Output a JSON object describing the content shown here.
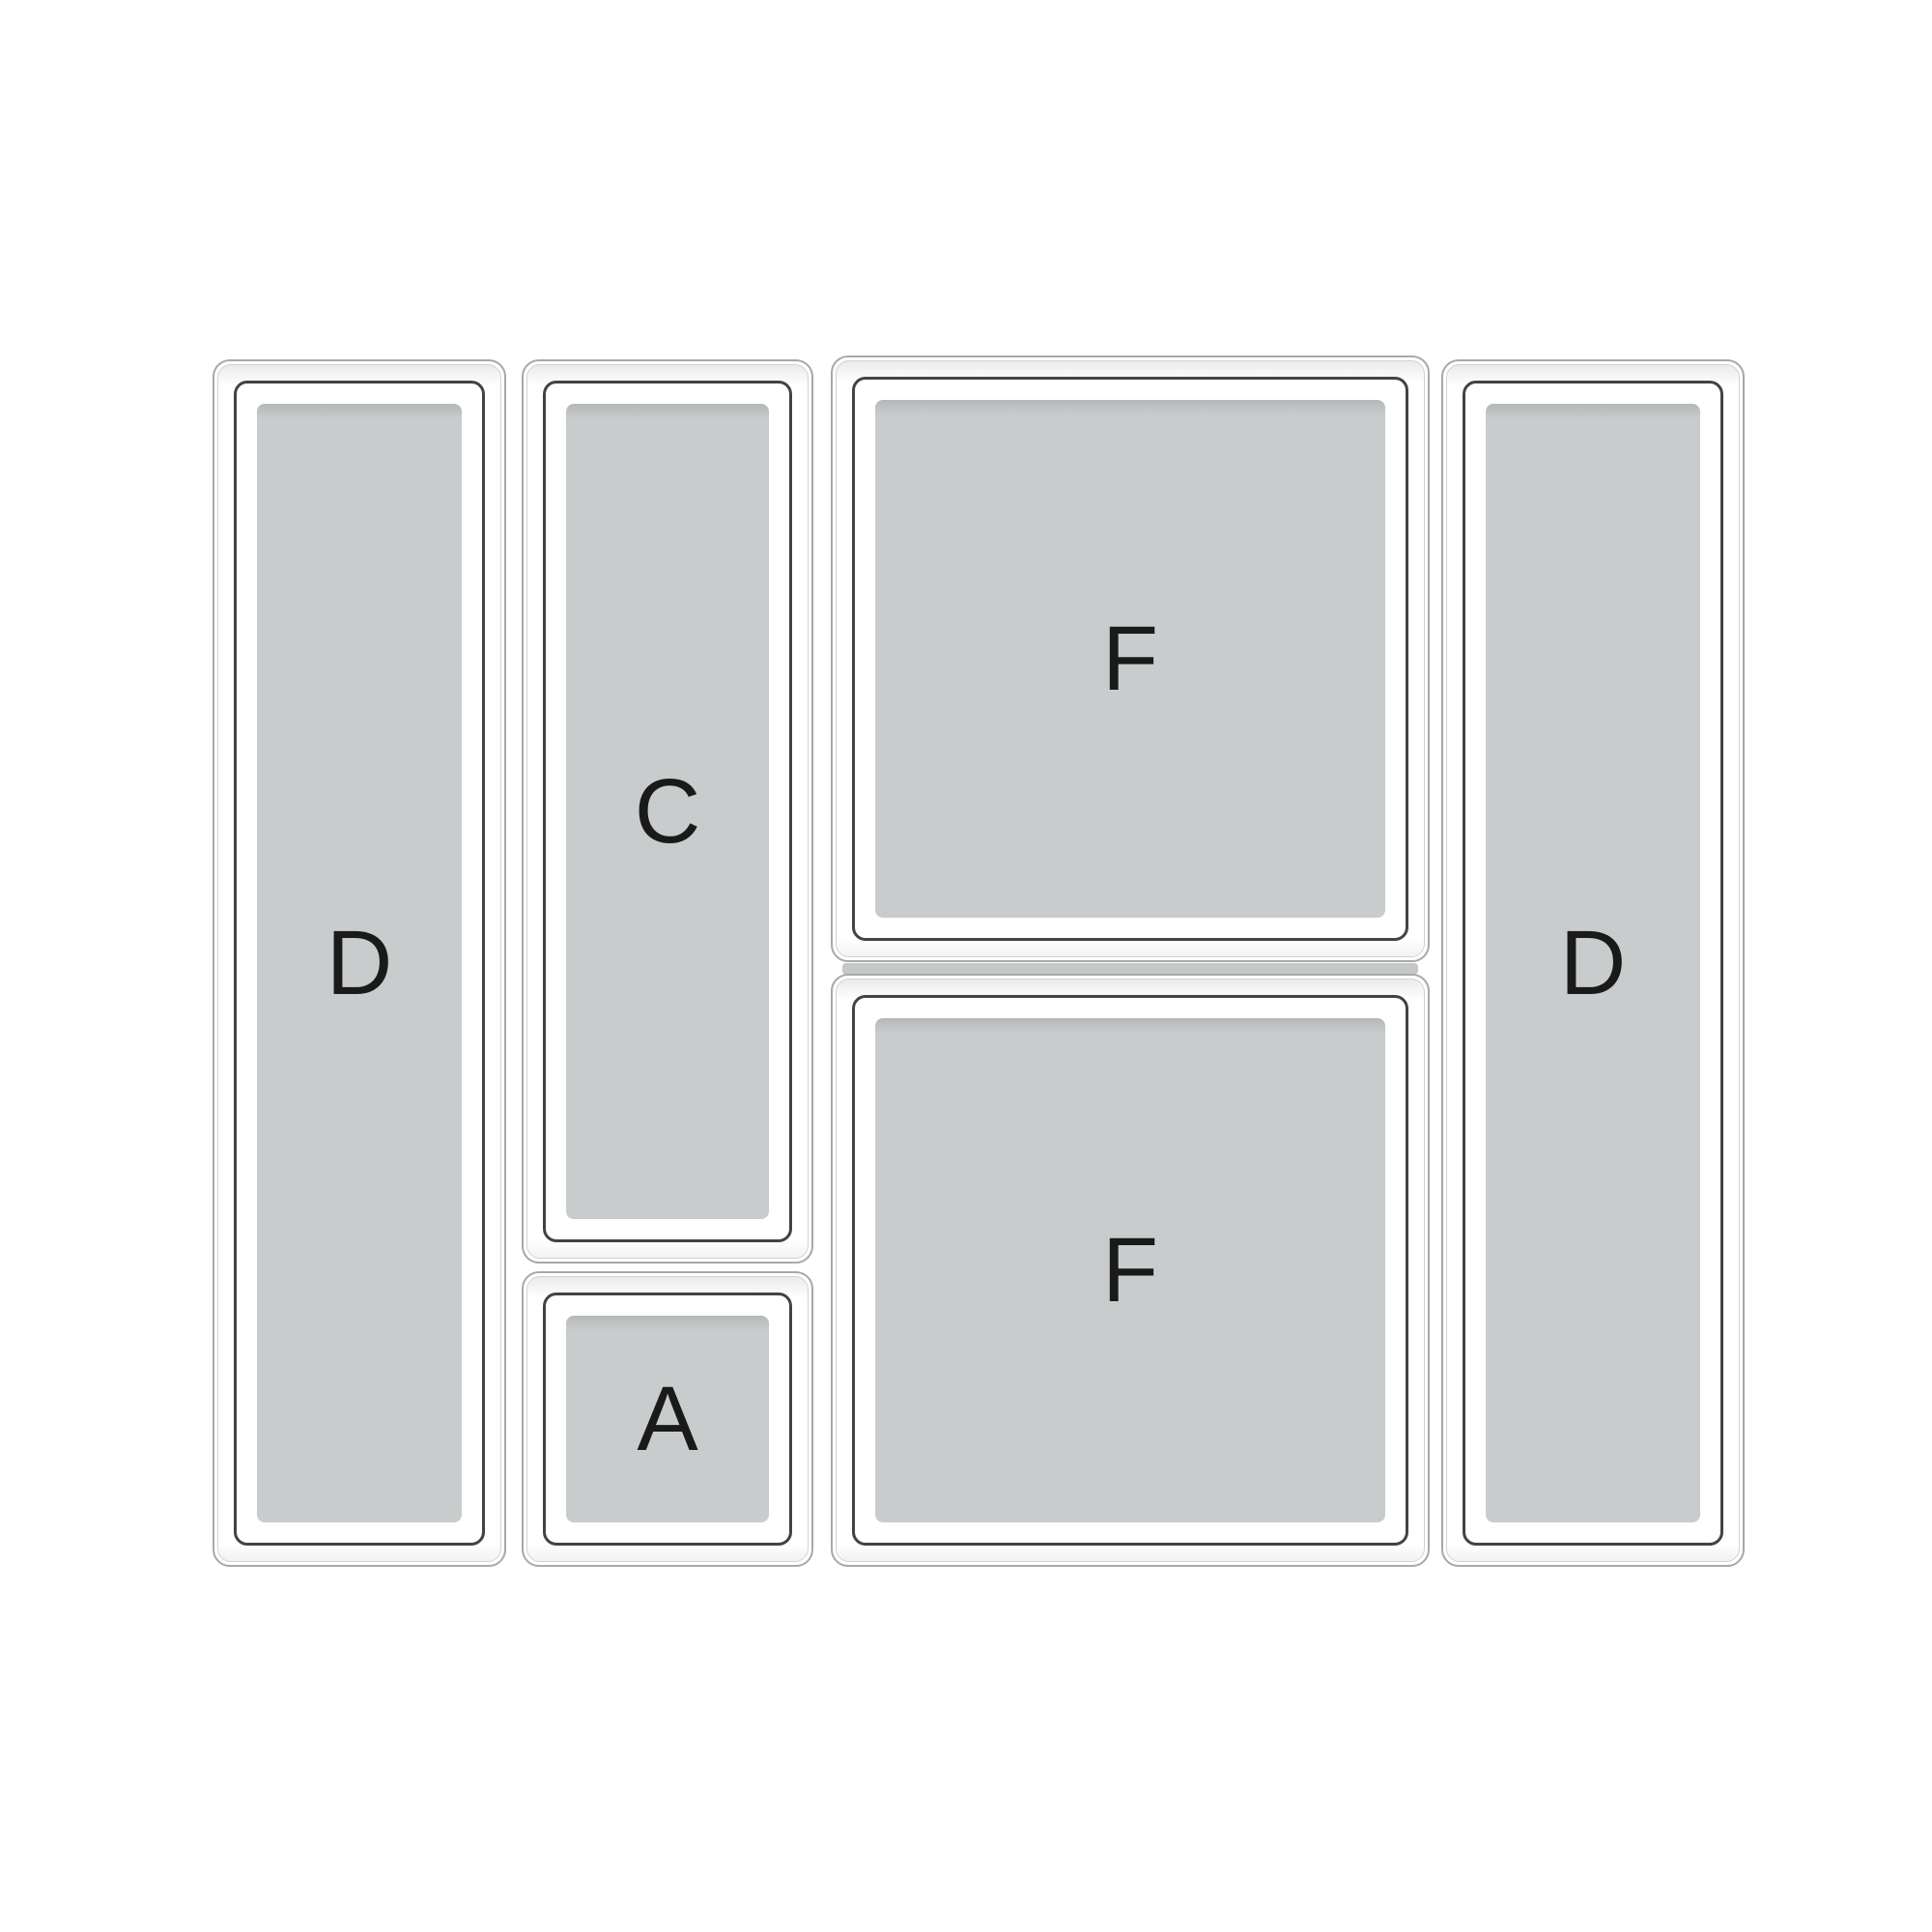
{
  "diagram": {
    "description": "drawer-organizer-tray-layout",
    "bins": [
      {
        "id": "d-left",
        "label": "D"
      },
      {
        "id": "c",
        "label": "C"
      },
      {
        "id": "a",
        "label": "A"
      },
      {
        "id": "f-top",
        "label": "F"
      },
      {
        "id": "f-bottom",
        "label": "F"
      },
      {
        "id": "d-right",
        "label": "D"
      }
    ],
    "colors": {
      "background": "#ffffff",
      "tray_fill": "#c9cccd",
      "tray_fill_edge": "#b5b8b9",
      "wall_border": "#434343",
      "outer_edge": "#a8a8a8",
      "inner_lip": "#d2d2d2",
      "gap_shadow": "#c5c8c9",
      "label_text": "#1a1a1a"
    }
  }
}
